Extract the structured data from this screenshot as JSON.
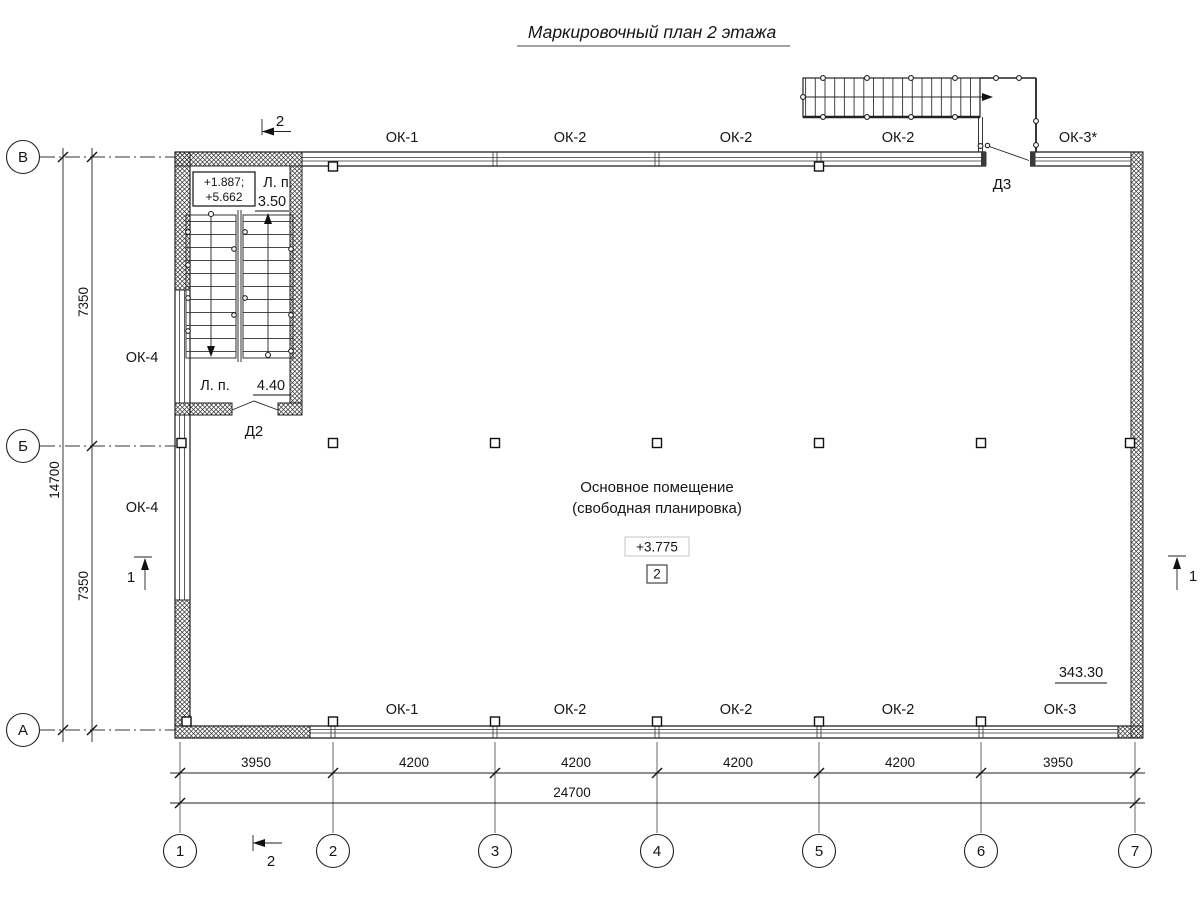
{
  "title": "Маркировочный план 2 этажа",
  "colors": {
    "ink": "#1a1a1a",
    "elevation_box": "#c4c4c4"
  },
  "room": {
    "name_line1": "Основное помещение",
    "name_line2": "(свободная планировка)",
    "elevation": "+3.775",
    "number": "2"
  },
  "stair": {
    "levels_line1": "+1.887;",
    "levels_line2": "+5.662",
    "landing_abbr_top": "Л. п.",
    "landing_value_top": "3.50",
    "landing_abbr_bottom": "Л. п.",
    "landing_value_bottom": "4.40"
  },
  "doors": {
    "d2": "Д2",
    "d3": "Д3"
  },
  "windows": {
    "top": [
      "ОК-1",
      "ОК-2",
      "ОК-2",
      "ОК-2",
      "ОК-3*"
    ],
    "bottom": [
      "ОК-1",
      "ОК-2",
      "ОК-2",
      "ОК-2",
      "ОК-3"
    ],
    "left": [
      "ОК-4",
      "ОК-4"
    ]
  },
  "area_mark": "343.30",
  "axes": {
    "cols": [
      "1",
      "2",
      "3",
      "4",
      "5",
      "6",
      "7"
    ],
    "rows": [
      "В",
      "Б",
      "А"
    ]
  },
  "dims": {
    "bottom": [
      "3950",
      "4200",
      "4200",
      "4200",
      "4200",
      "3950"
    ],
    "total_bottom": "24700",
    "left": [
      "7350",
      "7350"
    ],
    "total_left": "14700"
  },
  "sections": {
    "sec1": "1",
    "sec2": "2"
  }
}
